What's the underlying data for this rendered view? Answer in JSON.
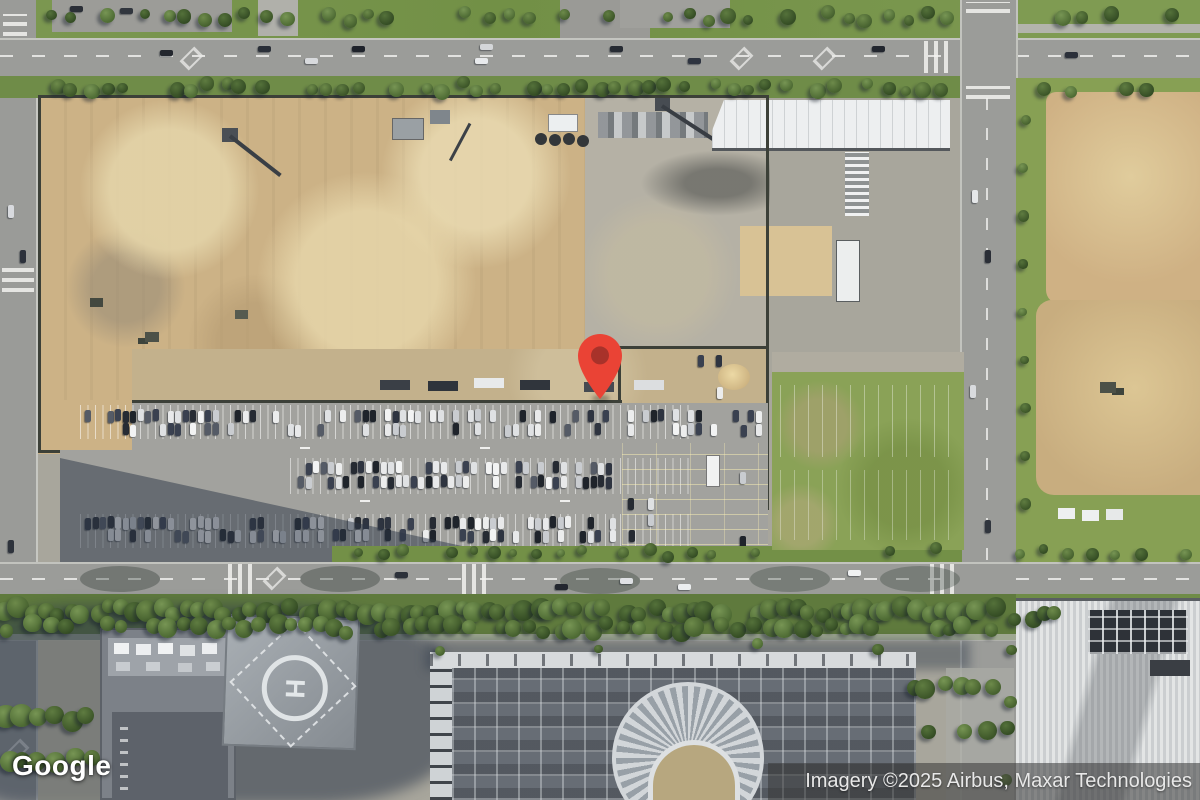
{
  "map": {
    "provider_logo": "Google",
    "attribution": "Imagery ©2025 Airbus, Maxar Technologies",
    "helipad_letter": "H",
    "marker": {
      "color": "#EA4335",
      "dot_color": "#A8322A"
    }
  },
  "palette": {
    "logo_color": "#FFFFFF",
    "attribution_bg": "rgba(55,55,55,0.55)",
    "attribution_text": "#E8E8E8",
    "road": "#9B9C99",
    "parking": "#A2A29E",
    "concrete": "#B5B1A5",
    "dirt": "#CCB286",
    "dirt_light": "#E3D3A8",
    "grass": "#7E9B50",
    "grass_dark": "#5F7A3D",
    "tree_hi": "#6D8A4A",
    "tree_lo": "#45602E",
    "shadow": "#2C3748",
    "building_white": "#EDEFF0",
    "roof_gray": "#7C8188",
    "complex_roof": "#676D75"
  }
}
